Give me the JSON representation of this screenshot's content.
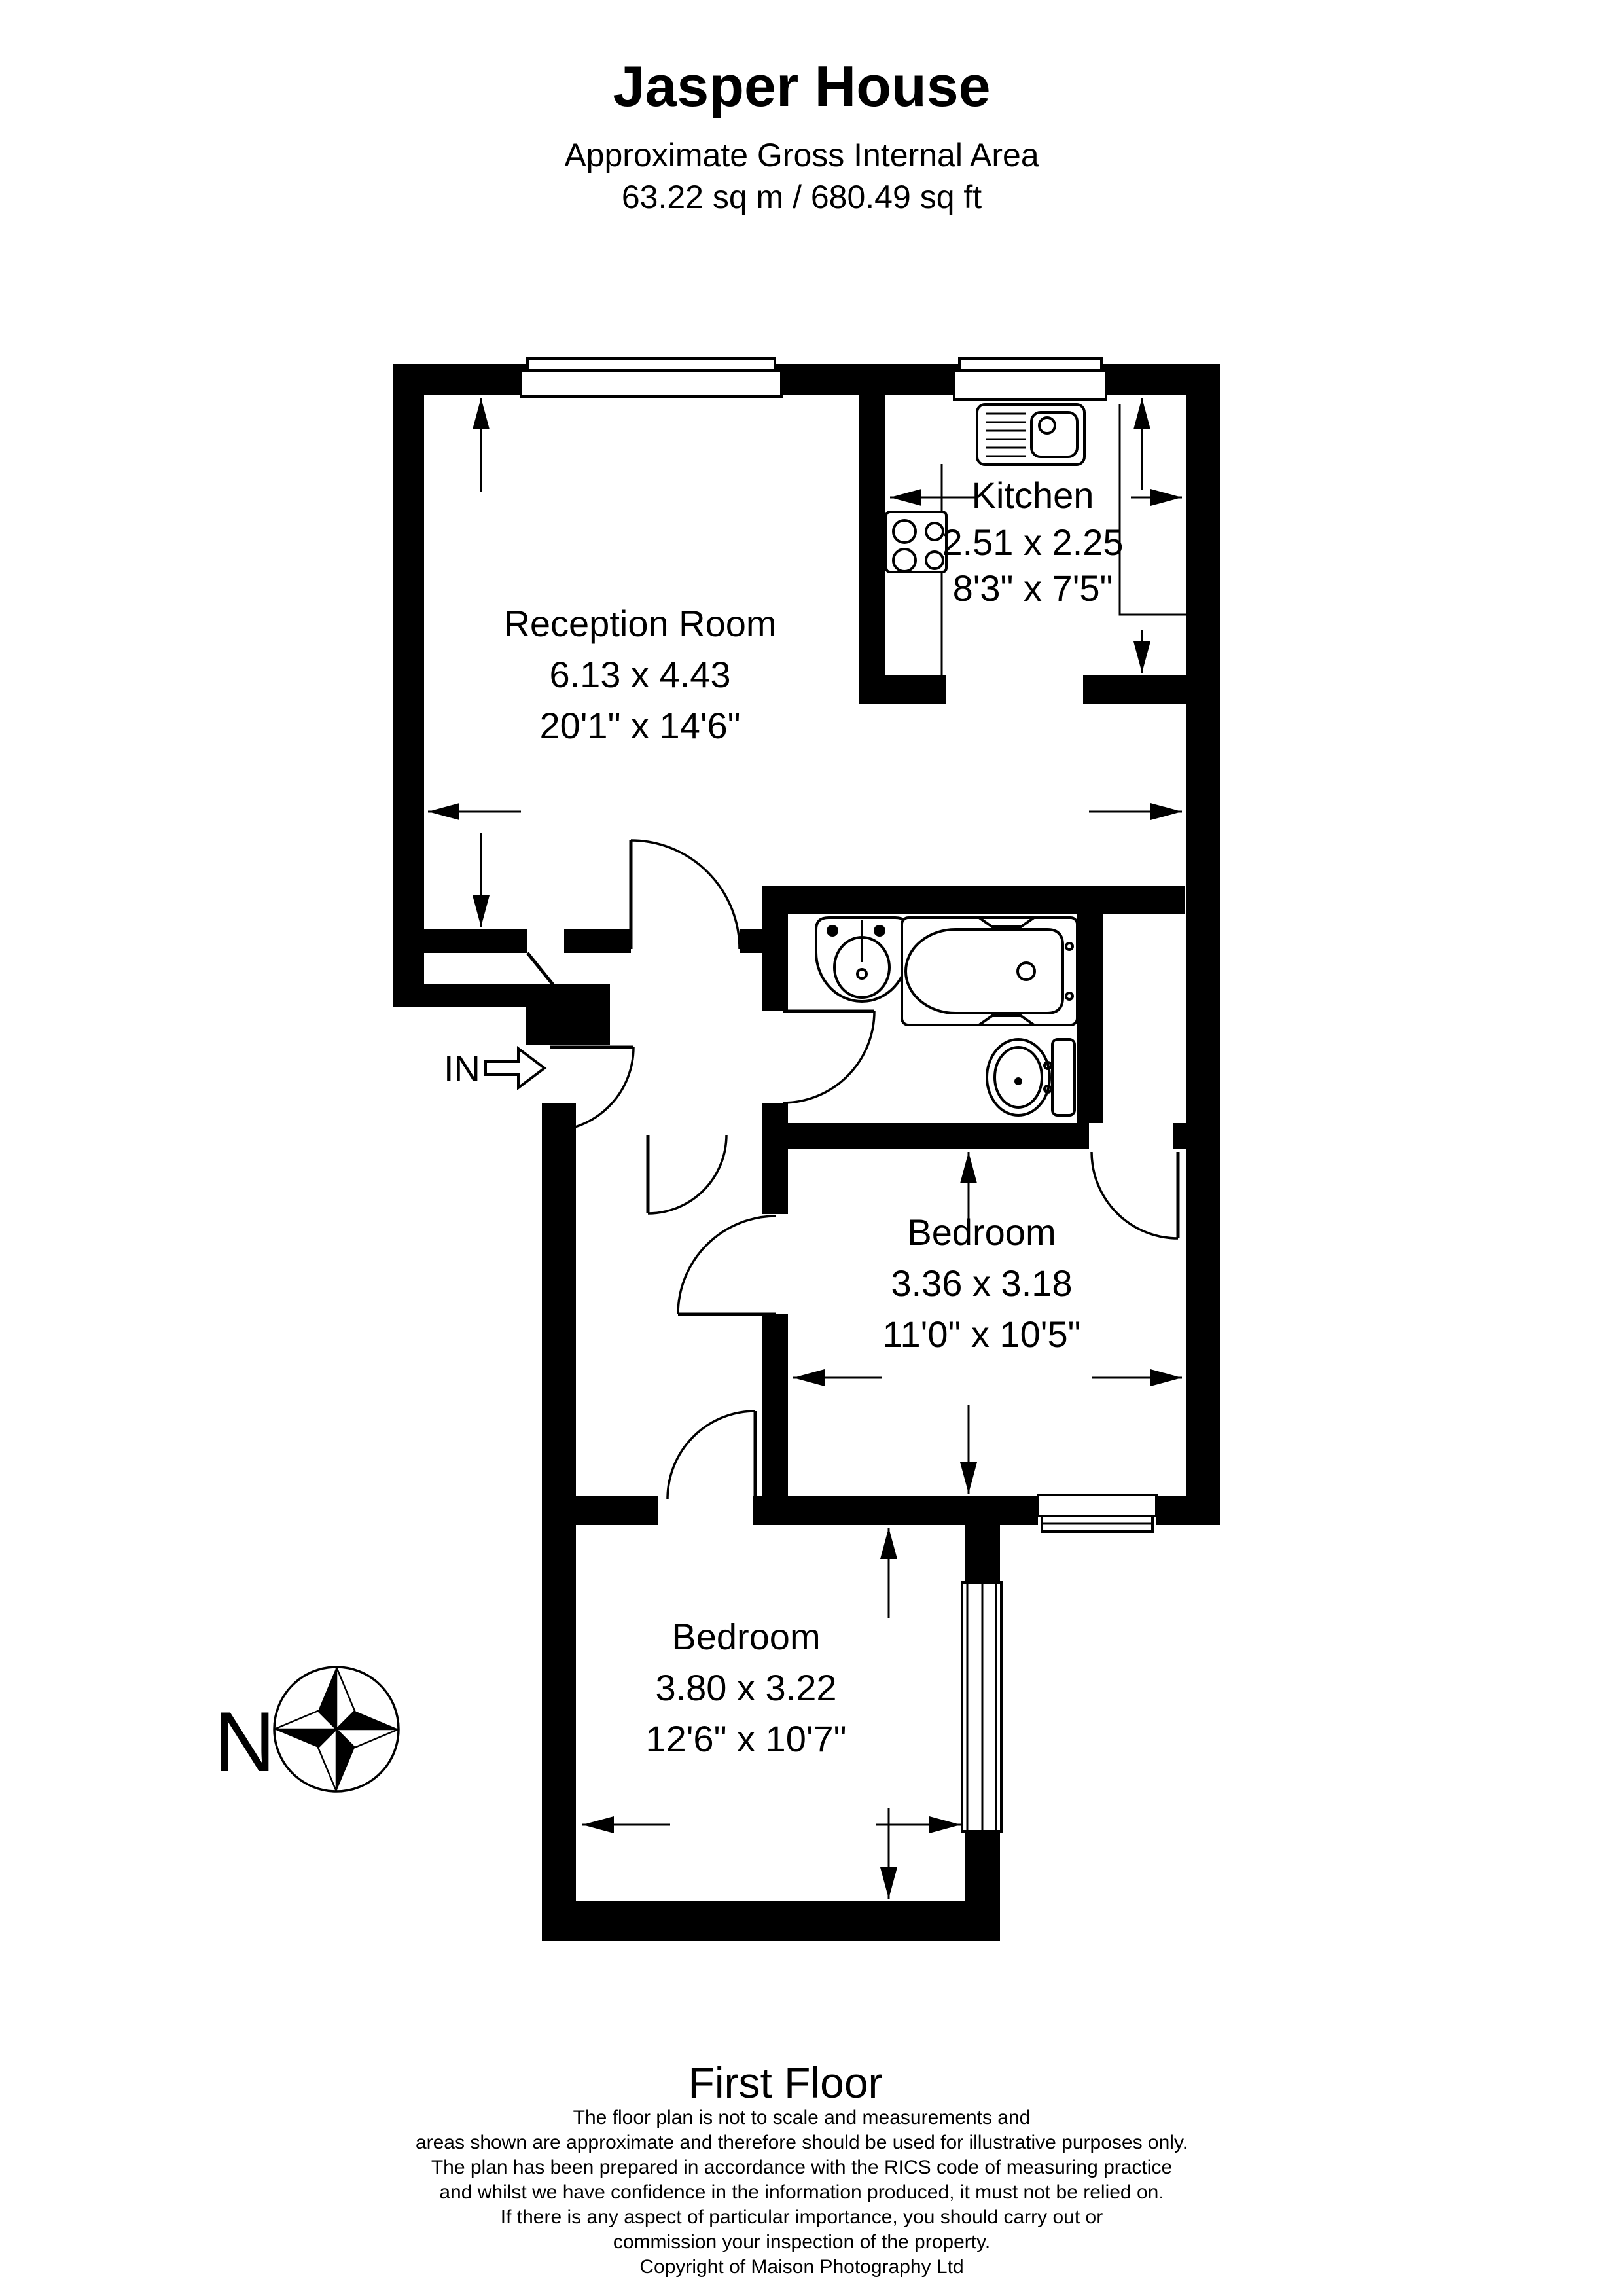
{
  "header": {
    "title": "Jasper House",
    "subtitle": "Approximate Gross Internal Area",
    "area": "63.22 sq m / 680.49 sq ft"
  },
  "rooms": [
    {
      "id": "reception",
      "name": "Reception Room",
      "metric": "6.13 x 4.43",
      "imperial": "20'1\" x 14'6\""
    },
    {
      "id": "kitchen",
      "name": "Kitchen",
      "metric": "2.51 x 2.25",
      "imperial": "8'3\" x 7'5\""
    },
    {
      "id": "bedroom-1",
      "name": "Bedroom",
      "metric": "3.36 x 3.18",
      "imperial": "11'0\" x 10'5\""
    },
    {
      "id": "bedroom-2",
      "name": "Bedroom",
      "metric": "3.80 x 3.22",
      "imperial": "12'6\" x 10'7\""
    }
  ],
  "labels": {
    "entrance": "IN",
    "compass_north": "N",
    "floor": "First Floor"
  },
  "disclaimer": {
    "lines": [
      "The floor plan is not to scale and measurements and",
      "areas shown are approximate and therefore should be used for illustrative purposes only.",
      "The plan has been prepared in accordance with the RICS code of measuring practice",
      "and whilst we have confidence in the information produced, it must not be relied on.",
      "If there is any aspect of particular importance, you should carry out or",
      "commission your inspection of the property.",
      "Copyright of Maison Photography Ltd"
    ]
  },
  "colors": {
    "ink": "#000000",
    "paper": "#ffffff"
  }
}
